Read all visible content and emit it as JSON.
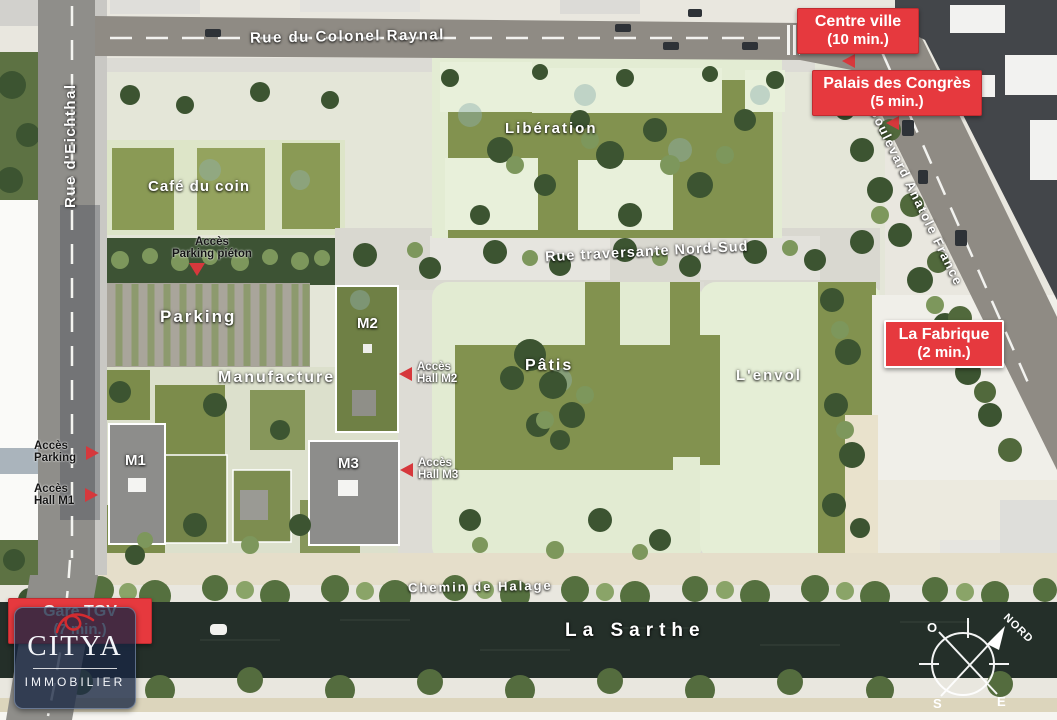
{
  "streets": {
    "colonel_raynal": "Rue du Colonel Raynal",
    "eichthal": "Rue d'Eichthal",
    "anatole_france": "Boulevard Anatole France",
    "traversante": "Rue traversante Nord-Sud",
    "halage": "Chemin de Halage"
  },
  "river": {
    "name": "La Sarthe"
  },
  "areas": {
    "liberation": "Libération",
    "cafe": "Café du coin",
    "parking": "Parking",
    "manufacture": "Manufacture",
    "patis": "Pâtis",
    "envol": "L'envol"
  },
  "buildings": {
    "m1": "M1",
    "m2": "M2",
    "m3": "M3"
  },
  "access": {
    "parking_pieton": {
      "line1": "Accès",
      "line2": "Parking piéton"
    },
    "parking": {
      "line1": "Accès",
      "line2": "Parking"
    },
    "hall_m1": {
      "line1": "Accès",
      "line2": "Hall M1"
    },
    "hall_m2": {
      "line1": "Accès",
      "line2": "Hall M2"
    },
    "hall_m3": {
      "line1": "Accès",
      "line2": "Hall M3"
    }
  },
  "callouts": {
    "centre_ville": {
      "line1": "Centre ville",
      "line2": "(10 min.)"
    },
    "palais": {
      "line1": "Palais des Congrès",
      "line2": "(5 min.)"
    },
    "fabrique": {
      "line1": "La Fabrique",
      "line2": "(2 min.)"
    },
    "gare": {
      "line1": "Gare TGV",
      "line2": "(7 min.)"
    }
  },
  "compass": {
    "north": "NORD",
    "west": "O",
    "south": "S",
    "east": "E"
  },
  "logo": {
    "brand": "CITYA",
    "subtitle": "IMMOBILIER"
  },
  "colors": {
    "callout_red": "#e6393e",
    "river": "#242f29",
    "lawn": "#82924f",
    "pale_building": "#e6eed8",
    "road": "#8f8b84"
  }
}
